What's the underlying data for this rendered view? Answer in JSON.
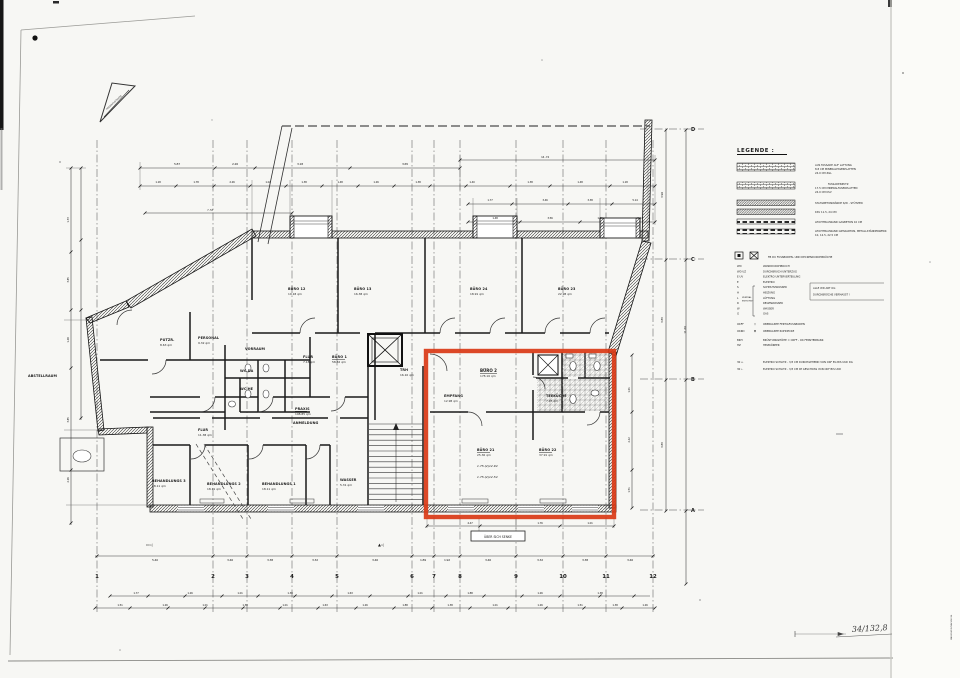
{
  "sheet": {
    "handwritten_number": "34/132,8",
    "margin_vertical_note": "MAUERWERKSACHSE 84",
    "under_box_label": "ÜBER SICH SENKE"
  },
  "north_arrow": {
    "street_label": "FRIEDRICHSTRASSE"
  },
  "grid": {
    "cols": [
      "1",
      "2",
      "3",
      "4",
      "5",
      "6",
      "7",
      "8",
      "9",
      "10",
      "11",
      "12"
    ],
    "rows": [
      "D",
      "C",
      "B",
      "A"
    ]
  },
  "dims": {
    "col": [
      "5.40",
      "3.46",
      "3.38",
      "3.32",
      "3.46",
      "1.89",
      "1.92",
      "3.46",
      "3.32",
      "3.38",
      "3.46"
    ],
    "row": [
      "3.96",
      "3.85",
      "3.85",
      "11.66"
    ],
    "top1": [
      "5.87",
      "2.26",
      "3.18",
      "3.65"
    ],
    "top_long": "14.74",
    "top2": [
      "1.18",
      "1.78",
      "2.26",
      "1.02",
      "1.38",
      "1.48",
      "1.26",
      "1.38",
      "1.40",
      "1.38",
      "1.48",
      "1.18"
    ],
    "top3": [
      "1.77",
      "3.46",
      "3.38",
      "5.14"
    ],
    "top4": [
      "1.48",
      "3.56",
      "1.41",
      "5.14"
    ],
    "left": [
      "1.33",
      "3.85",
      "1.48",
      "3.85",
      "2.26"
    ],
    "left_small": "7.53",
    "bottom1": [
      "1.77",
      "1.26",
      "1.01",
      "1.38",
      "1.63",
      "1.01",
      "1.88",
      "1.26",
      "1.38"
    ],
    "bottom2": [
      "1.51",
      "1.26",
      "1.01",
      "1.38",
      "1.01",
      "1.63",
      "1.26",
      "1.88",
      "1.38",
      "1.01",
      "1.26",
      "1.51",
      "1.38",
      "1.26"
    ],
    "red_right": [
      "1.01",
      "2.42",
      "1.51"
    ],
    "below_red": [
      "4.47",
      "1.76",
      "1.01"
    ]
  },
  "rooms": [
    {
      "label": "BÜRO 12",
      "area": "19.18 qm"
    },
    {
      "label": "BÜRO 13",
      "area": "16.38 qm"
    },
    {
      "label": "BÜRO 24",
      "area": "18.91 qm"
    },
    {
      "label": "BÜRO 23",
      "area": "22.98 qm"
    },
    {
      "label": "PUTZR.",
      "area": "8.63 qm"
    },
    {
      "label": "PERSONAL",
      "area": "9.32 qm"
    },
    {
      "label": "VORRAUM",
      "area": ""
    },
    {
      "label": "FLUR",
      "area": "7.18 qm"
    },
    {
      "label": "BÜRO 1",
      "area": "58.32 qm"
    },
    {
      "label": "PRAXIS",
      "area": "108.85 qm"
    },
    {
      "label": "ANMELDUNG",
      "area": ""
    },
    {
      "label": "ABSTELLRAUM",
      "area": ""
    },
    {
      "label": "FLUR",
      "area": "11.38 qm"
    },
    {
      "label": "BEHANDLUNGS 3",
      "area": "18.11 qm"
    },
    {
      "label": "BEHANDLUNGS 2",
      "area": "18.11 qm"
    },
    {
      "label": "BEHANDLUNGS 1",
      "area": "18.11 qm"
    },
    {
      "label": "WASSER",
      "area": "5.31 qm"
    },
    {
      "label": "TRH",
      "area": "16.10 qm"
    },
    {
      "label": "WC DA",
      "area": ""
    },
    {
      "label": "WC HE",
      "area": ""
    }
  ],
  "red_zone": {
    "title": "BÜRO 2",
    "title_area": "178.16 qm",
    "empfang": "EMPFANG",
    "empfang_area": "12.98 qm",
    "teekueche": "TEEKÜCHE",
    "teekueche_area": "7.95 qm",
    "buero21": "BÜRO 21",
    "buero21_area": "25.36 qm",
    "buero22": "BÜRO 22",
    "buero22_area": "37.91 qm",
    "pencil_notes": [
      "1.75-(2)12.94",
      "1.75-(2)12.54"
    ],
    "highlight_color": "#d93a17"
  },
  "markers": [
    "▭◁",
    "▲◁"
  ],
  "legend": {
    "title": "LEGENDE :",
    "materials": [
      {
        "l1": "AUS FASSADE AUF LATTUNG",
        "l2": "8.8 CM MINERALFASERPLATTEN",
        "l3": "24.0 CM ZGL"
      },
      {
        "l1": "FASSADENPUTZ",
        "l2": "17.5 CM MINERALFASERPLATTEN",
        "l3": "24.0 CM KSV"
      },
      {
        "l1": "STAHLBETONWÄNDE S/W - STÜTZEN",
        "l2": "",
        "l3": ""
      },
      {
        "l1": "KSV 11.5, 24 CM",
        "l2": "",
        "l3": ""
      },
      {
        "l1": "LEICHTBAUWAND GASBETON 10 CM",
        "l2": "",
        "l3": ""
      },
      {
        "l1": "LEICHTBAUWAND GIPSKARTON, METALLSTÄNDERWERK",
        "l2": "10, 12.5, 22.5 CM",
        "l3": ""
      }
    ],
    "openings_title": "FB  DU  FUSSBODEN- UND DECKENDURCHBRÜCHE",
    "abbrevs": [
      [
        "WD",
        "WANDDURCHBRUCH"
      ],
      [
        "WD UZ",
        "DURCHBRUCH UNTERZUG"
      ],
      [
        "E UV",
        "ELEKTRO UNTERVERTEILUNG"
      ],
      [
        "E",
        "ELEKTRO"
      ],
      [
        "S",
        "SCHMUTZWASSER"
      ],
      [
        "H",
        "HEIZUNG"
      ],
      [
        "L",
        "LÜFTUNG"
      ],
      [
        "R",
        "REGENWASSER"
      ],
      [
        "W",
        "WASSER"
      ],
      [
        "G",
        "GAS"
      ]
    ],
    "brace_note": [
      "ZENTRAL",
      "ENTSORGT"
    ],
    "side_note": [
      "ALLE WD ART OG",
      "DURCHBRÜCHE VERMASST !"
    ],
    "levels": [
      {
        "abbr": "OKFF",
        "sym": "▽",
        "text": "OBERKANTE FERTIGFUSSBODEN"
      },
      {
        "abbr": "OKRD",
        "sym": "▼",
        "text": "OBERKANTE ROHDECKE"
      }
    ],
    "misc": [
      {
        "abbr": "BRH",
        "text": "BRÜSTUNGSHÖHE = OKFF - OK FENSTERBANK"
      },
      {
        "abbr": "HZ",
        "text": "HEIZKÖRPER"
      }
    ],
    "elektro": [
      {
        "key": "30 ↔",
        "text": "ELEKTRO SCHLITZ - 3/3 CM DURCHGEHEND VON OKF EG BIS UKD DG"
      },
      {
        "key": "30 ←",
        "text": "ELEKTRO SCHLITZ - 3/3 CM IM GESCHOSS VON OKF BIS UKD"
      }
    ]
  }
}
